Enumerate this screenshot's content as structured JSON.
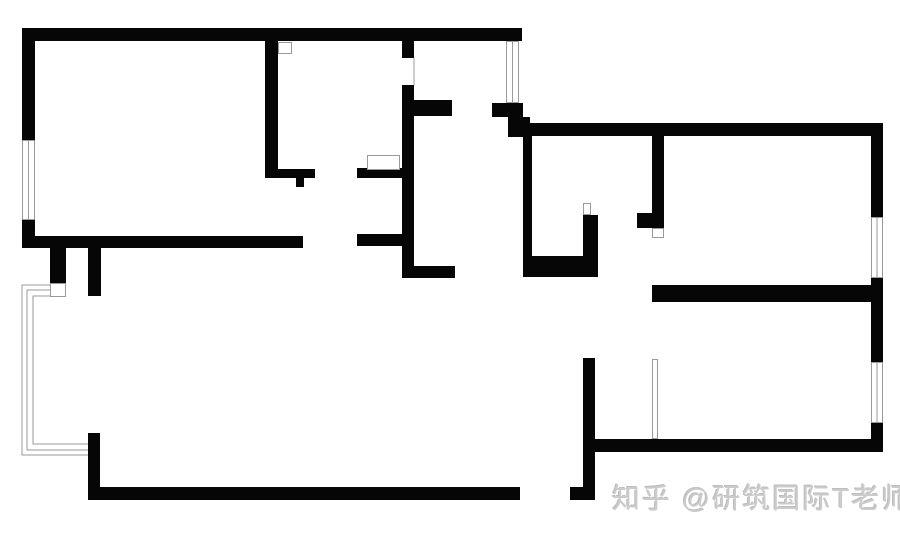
{
  "page": {
    "width": 900,
    "height": 543,
    "background": "#ffffff"
  },
  "watermark": {
    "text": "知乎 @研筑国际T老师",
    "color": "#cbcbcb"
  },
  "floorplan": {
    "wall_color": "#060606",
    "line_color": "#999999",
    "window_fill": "#ffffff",
    "walls": [
      [
        22,
        28,
        500,
        13,
        "north-wall-left-unit"
      ],
      [
        22,
        28,
        13,
        112,
        "west-wall-upper"
      ],
      [
        22,
        220,
        13,
        28,
        "west-wall-lower"
      ],
      [
        22,
        236,
        281,
        12,
        "living-room-south-wall"
      ],
      [
        50,
        248,
        16,
        37,
        "south-wall-stub-west"
      ],
      [
        88,
        248,
        13,
        48,
        "south-wall-stub-east"
      ],
      [
        265,
        41,
        13,
        131,
        "kitchen-west-wall"
      ],
      [
        265,
        169,
        50,
        9,
        "kitchen-southwest-wall"
      ],
      [
        296,
        178,
        8,
        9,
        "kitchen-south-stub"
      ],
      [
        357,
        168,
        45,
        10,
        "kitchen-southeast-wall"
      ],
      [
        357,
        234,
        45,
        12,
        "hall-north-wall-west"
      ],
      [
        402,
        41,
        12,
        17,
        "bath-west-wall-upper"
      ],
      [
        402,
        85,
        12,
        193,
        "bath-west-wall"
      ],
      [
        412,
        100,
        40,
        16,
        "bath-north-wall"
      ],
      [
        402,
        266,
        53,
        12,
        "hall-south-wall-west"
      ],
      [
        492,
        103,
        31,
        14,
        "shaft-south-wall"
      ],
      [
        508,
        117,
        22,
        20,
        "shaft-corner-block"
      ],
      [
        520,
        123,
        363,
        13,
        "north-wall-right-unit"
      ],
      [
        523,
        136,
        9,
        139,
        "right-unit-west-wall"
      ],
      [
        523,
        256,
        75,
        21,
        "small-room-south-wall"
      ],
      [
        583,
        215,
        15,
        62,
        "small-room-east-wall"
      ],
      [
        652,
        136,
        12,
        77,
        "closet-west-wall"
      ],
      [
        637,
        213,
        27,
        15,
        "closet-stub"
      ],
      [
        652,
        285,
        231,
        17,
        "bedroom-north-wall"
      ],
      [
        871,
        123,
        12,
        94,
        "east-wall-upper"
      ],
      [
        871,
        278,
        12,
        84,
        "east-wall-middle"
      ],
      [
        871,
        423,
        12,
        29,
        "east-wall-lower"
      ],
      [
        593,
        439,
        290,
        13,
        "south-wall-right-unit"
      ],
      [
        583,
        358,
        12,
        142,
        "central-south-wall"
      ],
      [
        88,
        487,
        432,
        13,
        "south-wall-left-unit"
      ],
      [
        570,
        487,
        25,
        13,
        "south-wall-corner"
      ],
      [
        88,
        433,
        12,
        67,
        "southwest-corner-wall"
      ]
    ],
    "windows": [
      [
        22,
        140,
        13,
        80,
        "west-window"
      ],
      [
        506,
        41,
        13,
        62,
        "shaft-window"
      ],
      [
        871,
        217,
        12,
        61,
        "east-window-upper"
      ],
      [
        871,
        362,
        12,
        61,
        "east-window-lower"
      ]
    ],
    "markers": [
      [
        367,
        155,
        33,
        15,
        "kitchen-counter"
      ],
      [
        278,
        42,
        14,
        12,
        "kitchen-door-marker"
      ],
      [
        583,
        203,
        8,
        12,
        "small-room-door"
      ],
      [
        652,
        228,
        12,
        10,
        "closet-door"
      ],
      [
        652,
        359,
        6,
        80,
        "bedroom-sliding-door"
      ],
      [
        50,
        283,
        16,
        14,
        "bay-window-sill"
      ]
    ],
    "bay_polylines": [
      "50,285 22,285 22,455 88,455",
      "50,290 27,290 27,450 88,450",
      "50,296 33,296 33,444 88,444"
    ],
    "hairlines": [
      [
        414,
        58,
        414,
        85,
        "bath-door-frame-line"
      ]
    ]
  }
}
